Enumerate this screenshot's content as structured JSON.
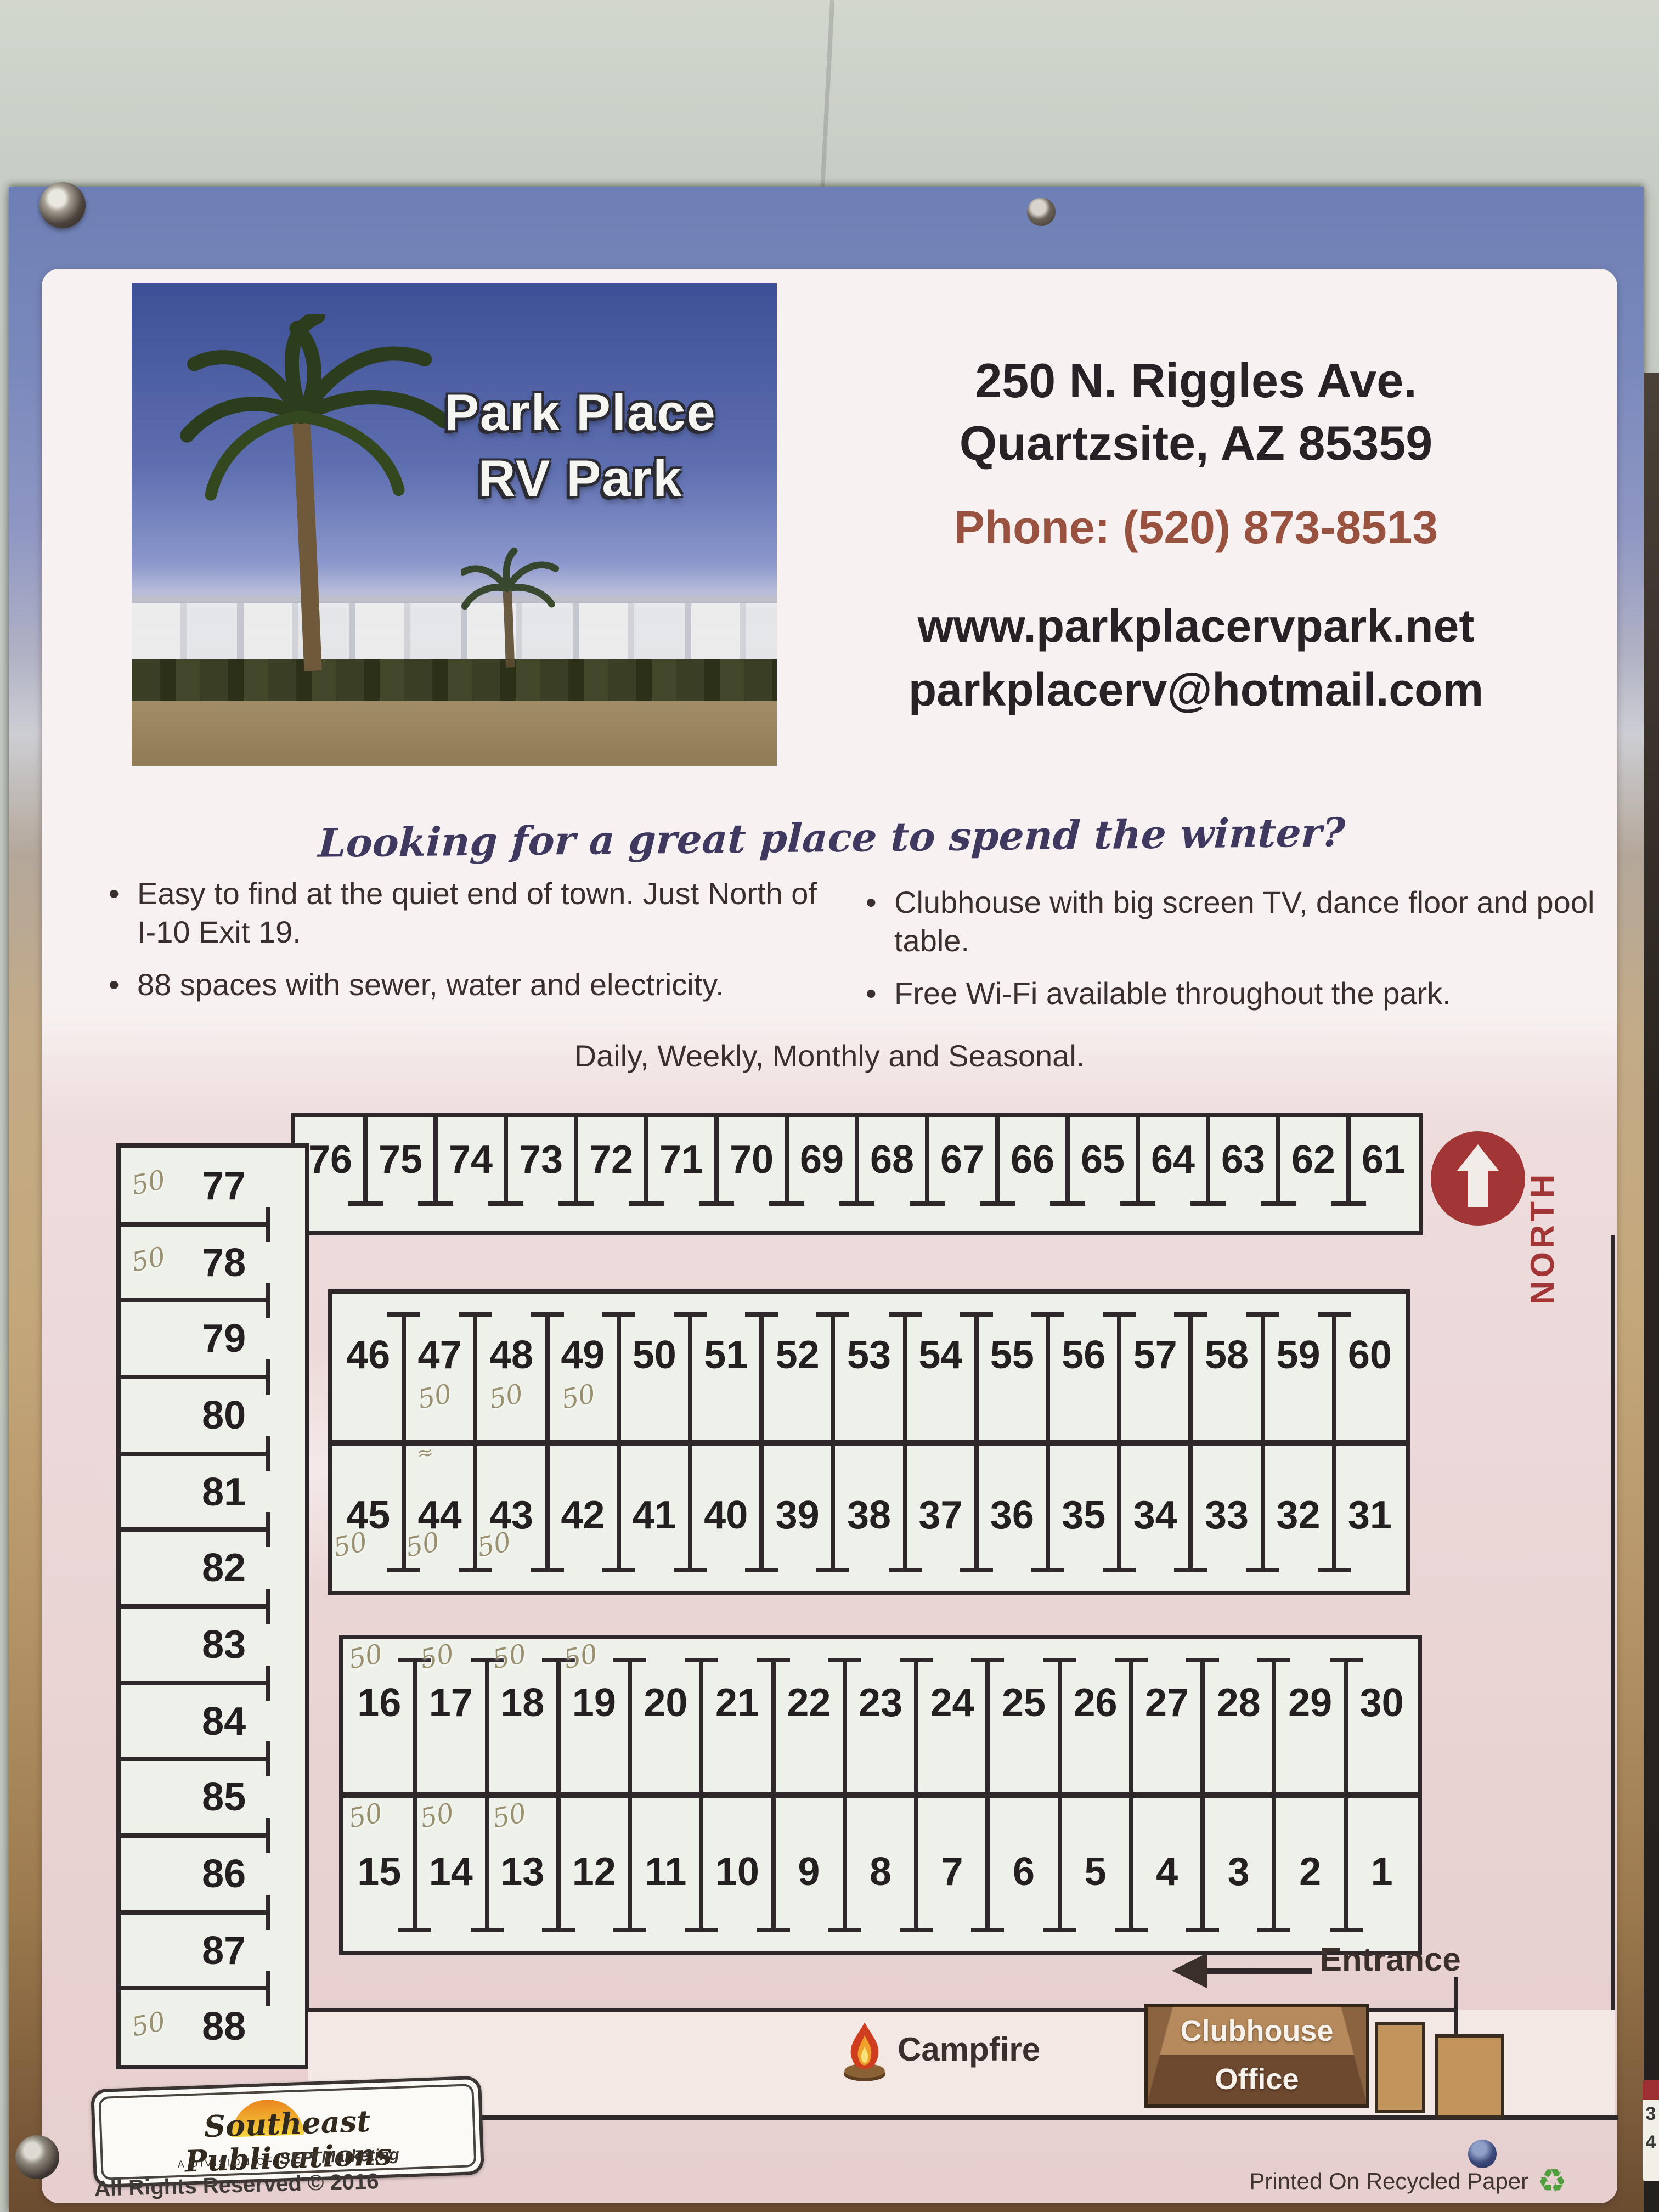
{
  "poster": {
    "photo": {
      "title_line1": "Park Place",
      "title_line2": "RV Park"
    },
    "contact": {
      "address_line1": "250 N. Riggles Ave.",
      "address_line2": "Quartzsite, AZ 85359",
      "phone": "Phone: (520) 873-8513",
      "website": "www.parkplacervpark.net",
      "email": "parkplacerv@hotmail.com"
    },
    "tagline": "Looking for a great place to spend the winter?",
    "bullets_left": [
      "Easy to find at the quiet end of town. Just North of I-10 Exit 19.",
      "88 spaces with sewer, water and  electricity."
    ],
    "bullets_right": [
      "Clubhouse with big screen TV, dance floor and pool table.",
      "Free Wi-Fi available throughout the park."
    ],
    "rates_line": "Daily, Weekly, Monthly and Seasonal."
  },
  "map": {
    "north_label": "NORTH",
    "entrance_label": "Entrance",
    "legend": {
      "campfire": "Campfire",
      "clubhouse_line1": "Clubhouse",
      "clubhouse_line2": "Office"
    },
    "rows": {
      "top": [
        "76",
        "75",
        "74",
        "73",
        "72",
        "71",
        "70",
        "69",
        "68",
        "67",
        "66",
        "65",
        "64",
        "63",
        "62",
        "61"
      ],
      "left": [
        {
          "n": "77",
          "note": "50"
        },
        {
          "n": "78",
          "note": "50"
        },
        {
          "n": "79"
        },
        {
          "n": "80"
        },
        {
          "n": "81"
        },
        {
          "n": "82"
        },
        {
          "n": "83"
        },
        {
          "n": "84"
        },
        {
          "n": "85"
        },
        {
          "n": "86"
        },
        {
          "n": "87"
        },
        {
          "n": "88",
          "note": "50"
        }
      ],
      "mid_upper": [
        {
          "n": "46"
        },
        {
          "n": "47",
          "note": "50"
        },
        {
          "n": "48",
          "note": "50"
        },
        {
          "n": "49",
          "note": "50"
        },
        {
          "n": "50"
        },
        {
          "n": "51"
        },
        {
          "n": "52"
        },
        {
          "n": "53"
        },
        {
          "n": "54"
        },
        {
          "n": "55"
        },
        {
          "n": "56"
        },
        {
          "n": "57"
        },
        {
          "n": "58"
        },
        {
          "n": "59"
        },
        {
          "n": "60"
        }
      ],
      "mid_lower": [
        {
          "n": "45",
          "note": "50"
        },
        {
          "n": "44",
          "note": "50",
          "mark": "≈"
        },
        {
          "n": "43",
          "note": "50"
        },
        {
          "n": "42"
        },
        {
          "n": "41"
        },
        {
          "n": "40"
        },
        {
          "n": "39"
        },
        {
          "n": "38"
        },
        {
          "n": "37"
        },
        {
          "n": "36"
        },
        {
          "n": "35"
        },
        {
          "n": "34"
        },
        {
          "n": "33"
        },
        {
          "n": "32"
        },
        {
          "n": "31"
        }
      ],
      "low_upper": [
        {
          "n": "16",
          "note": "50"
        },
        {
          "n": "17",
          "note": "50"
        },
        {
          "n": "18",
          "note": "50"
        },
        {
          "n": "19",
          "note": "50"
        },
        {
          "n": "20"
        },
        {
          "n": "21"
        },
        {
          "n": "22"
        },
        {
          "n": "23"
        },
        {
          "n": "24"
        },
        {
          "n": "25"
        },
        {
          "n": "26"
        },
        {
          "n": "27"
        },
        {
          "n": "28"
        },
        {
          "n": "29"
        },
        {
          "n": "30"
        }
      ],
      "low_lower": [
        {
          "n": "15",
          "note": "50"
        },
        {
          "n": "14",
          "note": "50"
        },
        {
          "n": "13",
          "note": "50"
        },
        {
          "n": "12"
        },
        {
          "n": "11"
        },
        {
          "n": "10"
        },
        {
          "n": "9"
        },
        {
          "n": "8"
        },
        {
          "n": "7"
        },
        {
          "n": "6"
        },
        {
          "n": "5"
        },
        {
          "n": "4"
        },
        {
          "n": "3"
        },
        {
          "n": "2"
        },
        {
          "n": "1"
        }
      ]
    }
  },
  "footer": {
    "publisher": "Southeast Publications",
    "division": "A DIVISION OF",
    "brand": "SEPI Marketing",
    "rights": "All Rights Reserved © 2016",
    "recycled": "Printed On Recycled Paper",
    "recycle_icon": "♻"
  },
  "edge_sign_fragment": {
    "digit_top": "3",
    "digit_bottom": "4"
  },
  "colors": {
    "accent_red": "#a23536",
    "phone_brown": "#98523f",
    "pencil_note": "#948a68",
    "map_pink": "#e9d2d2",
    "site_white": "#eef1ea",
    "clubhouse_tan": "#b68a5c",
    "clubhouse_brown": "#6d4930",
    "recycle_green": "#4f9f3f",
    "poster_sky_blue": "#6d7fb5",
    "desert_tan": "#b59567"
  }
}
